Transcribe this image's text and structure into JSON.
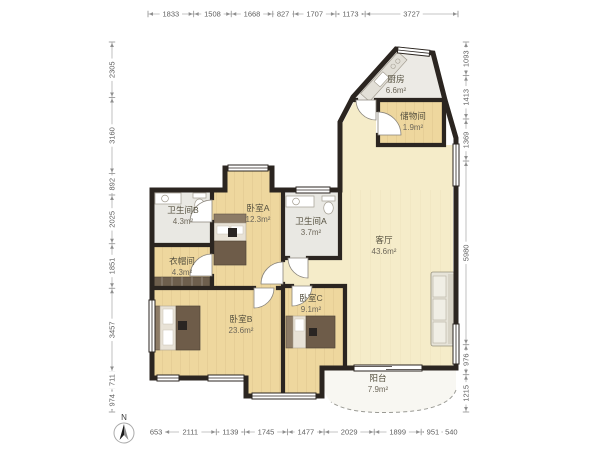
{
  "title": "apartment-floor-plan",
  "compass": {
    "label": "N"
  },
  "rooms": [
    {
      "id": "kitchen",
      "name": "厨房",
      "area": "6.6m²",
      "label_x": 396,
      "label_y": 82
    },
    {
      "id": "storage",
      "name": "储物间",
      "area": "1.9m²",
      "label_x": 413,
      "label_y": 119
    },
    {
      "id": "bath-b",
      "name": "卫生间B",
      "area": "4.3m²",
      "label_x": 183,
      "label_y": 213
    },
    {
      "id": "bedroom-a",
      "name": "卧室A",
      "area": "12.3m²",
      "label_x": 258,
      "label_y": 211
    },
    {
      "id": "bath-a",
      "name": "卫生间A",
      "area": "3.7m²",
      "label_x": 311,
      "label_y": 224
    },
    {
      "id": "living",
      "name": "客厅",
      "area": "43.6m²",
      "label_x": 384,
      "label_y": 243
    },
    {
      "id": "closet",
      "name": "衣帽间",
      "area": "4.3m²",
      "label_x": 182,
      "label_y": 264
    },
    {
      "id": "bedroom-b",
      "name": "卧室B",
      "area": "23.6m²",
      "label_x": 241,
      "label_y": 322
    },
    {
      "id": "bedroom-c",
      "name": "卧室C",
      "area": "9.1m²",
      "label_x": 311,
      "label_y": 301
    },
    {
      "id": "balcony",
      "name": "阳台",
      "area": "7.9m²",
      "label_x": 378,
      "label_y": 381
    }
  ],
  "dimensions": {
    "top": [
      1833,
      1508,
      1668,
      827,
      1707,
      1173,
      3727
    ],
    "bottom": [
      653,
      2111,
      1139,
      1745,
      1477,
      2029,
      1899,
      951,
      540
    ],
    "left": [
      2305,
      3160,
      892,
      2025,
      1851,
      3457,
      711,
      974
    ],
    "right": [
      1093,
      1413,
      1369,
      5980,
      976,
      1215
    ]
  },
  "colors": {
    "wall": "#2b2520",
    "wood_floor": "#eed79e",
    "living_floor": "#f5ecc9",
    "bath_floor": "#e9e8e3",
    "kitchen_floor": "#eceae5",
    "balcony_floor": "#f8f7f2",
    "dim_text": "#5f5f5f",
    "label_text": "#55503f"
  }
}
